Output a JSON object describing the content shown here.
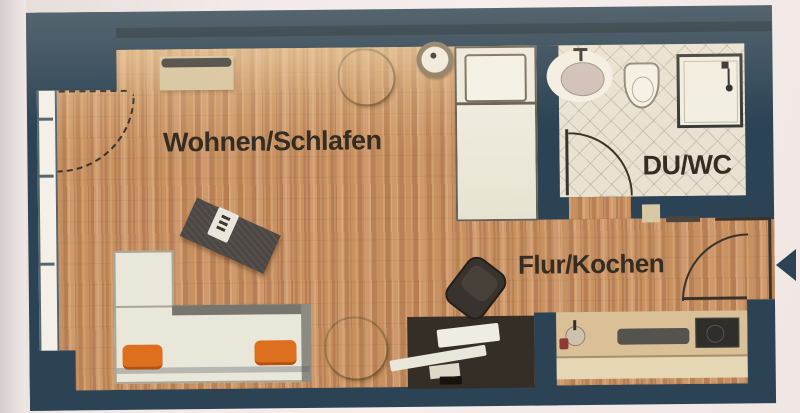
{
  "floorplan": {
    "rooms": [
      {
        "id": "wohnen-schlafen",
        "label": "Wohnen/Schlafen"
      },
      {
        "id": "du-wc",
        "label": "DU/WC"
      },
      {
        "id": "flur-kochen",
        "label": "Flur/Kochen"
      }
    ],
    "colors": {
      "wall": "#2b4355",
      "parquet": "#c18a5e",
      "tile": "#e9e2d2",
      "counter": "#d9c096",
      "cushion": "#dd6f1e",
      "label": "#342d24",
      "sofa": "#e9e6da",
      "rug": "#4c4742",
      "desk": "#352e27",
      "paper": "#f2e9e8"
    },
    "furniture": [
      "bed",
      "pillow",
      "round-side-table",
      "sideboard",
      "potted-plant",
      "lounge-rug",
      "l-shaped-sofa",
      "orange-cushions",
      "floor-plant",
      "desk",
      "office-chair",
      "kitchenette-counter",
      "kitchen-sink",
      "cooktop",
      "bathroom-sink",
      "toilet",
      "shower",
      "bathroom-door",
      "entrance-door",
      "window",
      "entrance-arrow"
    ]
  }
}
